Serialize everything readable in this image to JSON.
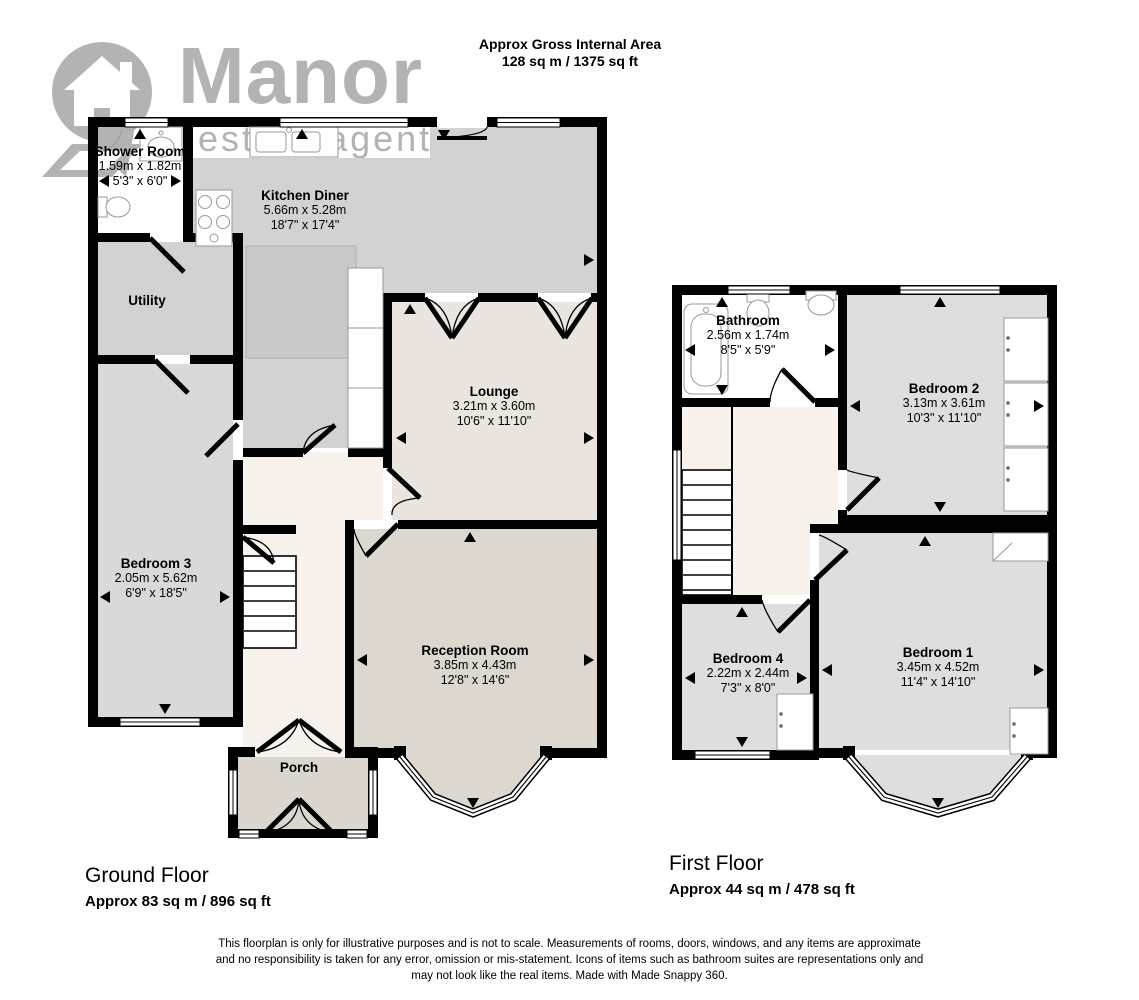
{
  "header": {
    "line1": "Approx Gross Internal Area",
    "line2": "128 sq m / 1375 sq ft"
  },
  "logo": {
    "name": "Manor",
    "tagline": "estate agent"
  },
  "ground_floor": {
    "title": "Ground Floor",
    "area": "Approx 83 sq m / 896 sq ft",
    "rooms": {
      "shower_room": {
        "name": "Shower Room",
        "metric": "1.59m x 1.82m",
        "imperial": "5'3\" x 6'0\""
      },
      "kitchen_diner": {
        "name": "Kitchen Diner",
        "metric": "5.66m x 5.28m",
        "imperial": "18'7\" x 17'4\""
      },
      "utility": {
        "name": "Utility"
      },
      "lounge": {
        "name": "Lounge",
        "metric": "3.21m x 3.60m",
        "imperial": "10'6\" x 11'10\""
      },
      "bedroom_3": {
        "name": "Bedroom 3",
        "metric": "2.05m x 5.62m",
        "imperial": "6'9\" x 18'5\""
      },
      "reception_room": {
        "name": "Reception Room",
        "metric": "3.85m x 4.43m",
        "imperial": "12'8\" x 14'6\""
      },
      "porch": {
        "name": "Porch"
      }
    }
  },
  "first_floor": {
    "title": "First Floor",
    "area": "Approx 44 sq m / 478 sq ft",
    "rooms": {
      "bathroom": {
        "name": "Bathroom",
        "metric": "2.56m x 1.74m",
        "imperial": "8'5\" x 5'9\""
      },
      "bedroom_2": {
        "name": "Bedroom 2",
        "metric": "3.13m x 3.61m",
        "imperial": "10'3\" x 11'10\""
      },
      "bedroom_4": {
        "name": "Bedroom 4",
        "metric": "2.22m x 2.44m",
        "imperial": "7'3\" x 8'0\""
      },
      "bedroom_1": {
        "name": "Bedroom 1",
        "metric": "3.45m x 4.52m",
        "imperial": "11'4\" x 14'10\""
      }
    }
  },
  "disclaimer": {
    "line1": "This floorplan is only for illustrative purposes and is not to scale. Measurements of rooms, doors, windows, and any items are approximate",
    "line2": "and no responsibility is taken for any error, omission or mis-statement. Icons of items such as bathroom suites are representations only and",
    "line3": "may not look like the real items. Made with Made Snappy 360."
  },
  "colors": {
    "wall": "#000000",
    "logo_gray": "#b3b3b3",
    "kitchen_gray": "#d2d2d2",
    "bedroom_gray": "#dedede",
    "bedroom3_gray": "#d9d9d9",
    "lounge_beige": "#eae6df",
    "reception_taupe": "#dcd7cf",
    "porch_taupe": "#dbd6ce",
    "hall_cream": "#f7f3ec",
    "furniture_gray": "#c9c9c9",
    "fixture_outline": "#999999"
  }
}
